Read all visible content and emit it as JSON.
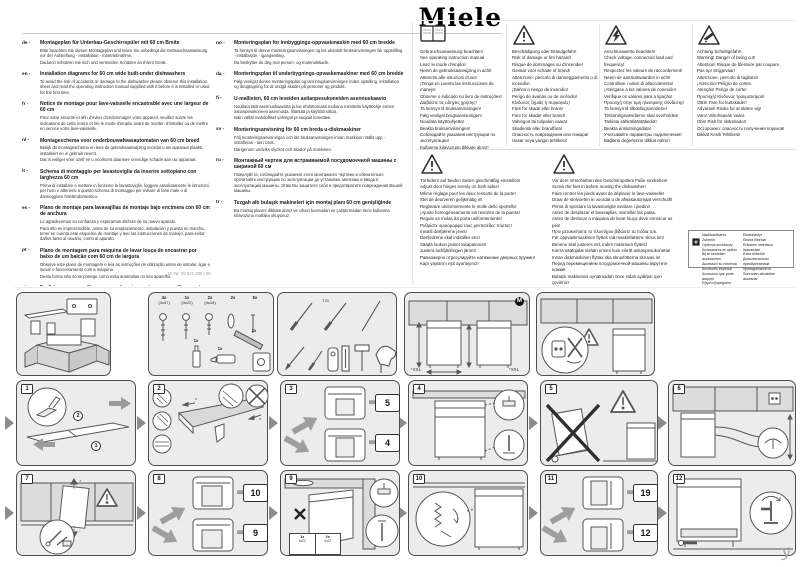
{
  "page": {
    "brand": "Miele",
    "doc_number": "M.-Nr. 09 521 280 / 00",
    "corner_mark": "y"
  },
  "intro": {
    "col1": [
      {
        "code": "de -",
        "title": "Montageplan für Unterbau-Geschirrspüler mit 60 cm Breite",
        "body": [
          "Bitte beachten Sie diesen Montageplan und lesen Sie unbedingt die Gebrauchsanweisung vor der Aufstellung - Installation - Inbetriebnahme.",
          "Dadurch schützen Sie sich und vermeiden Schäden an Ihrem Gerät."
        ]
      },
      {
        "code": "en -",
        "title": "Installation diagrams for 60 cm wide built-under dishwashers",
        "body": [
          "To avoid the risk of accidents or damage to the dishwasher please observe this installation sheet and read the operating instruction manual supplied with it before it is installed or used for the first time."
        ]
      },
      {
        "code": "fr -",
        "title": "Notice de montage pour lave-vaisselle encastrable avec une largeur de 60 cm",
        "body": [
          "Pour votre sécurité et afin d'éviter d'endommager votre appareil, veuillez suivre les indications de cette notice et lire le mode d'emploi avant de monter, d'installer ou de mettre en service votre lave-vaisselle."
        ]
      },
      {
        "code": "nl -",
        "title": "Montageschema voor onderbouwafwasautomaten van 60 cm breed",
        "body": [
          "Bekijk dit montageschema en lees de gebruiksaanwijzing voordat u uw apparaat plaatst, installeert en in gebruik neemt.",
          "Dat is veiliger voor uzelf en u voorkomt daarmee onnodige schade aan uw apparaat."
        ]
      },
      {
        "code": "it -",
        "title": "Schema di montaggio per lavastoviglie da inserire sottopiano con larghezza 60 cm",
        "body": [
          "Prima di installare e mettere in funzione la lavastoviglie, leggere assolutamente le istruzioni per l'uso e attenersi a questo schema di montaggio per evitare di farsi male o di danneggiare l'elettrodomestico."
        ]
      },
      {
        "code": "es -",
        "title": "Plano de montaje para lavavajillas de montaje bajo encimera con 60 cm de anchura",
        "body": [
          "Le agradecemos su confianza y esperamos disfrute de su nuevo aparato.",
          "Para ello es imprescindible, antes de su emplazamiento, instalación y puesta en marcha, tener en cuenta este esquema de montaje y leer las instrucciones de manejo, para evitar daños tanto al usuario, como al aparato."
        ]
      },
      {
        "code": "pt -",
        "title": "Plano de montagem para máquina de lavar louça de encastrar por baixo de um balcão com 60 cm de largura",
        "body": [
          "Observe este plano de montagem e leia as instruções de utilização antes de instalar, ligar e iniciar o funcionamento com a máquina.",
          "Desta forma não só se protege como evita anomalias no seu aparelho."
        ]
      },
      {
        "code": "el -",
        "title": "Σχεδιάγραμμα τοποθέτησης για πλυντήρια πιάτων εντοιχιζόμενα κάτω από πάγκο με 60 εκ. πλάτος",
        "body": [
          "Λάβετε υπόψη σας αυτό το σχεδιάγραμμα τοποθέτησης και διαβάστε οπωσδήποτε τις οδηγίες χρήσης, πριν από την τοποθέτηση - σύνδεση - αρχική λειτουργία.",
          "Έτσι προστατεύετε τον εαυτό σας και αποφεύγετε ζημιές στη συσκευή σας."
        ]
      }
    ],
    "col2": [
      {
        "code": "no -",
        "title": "Monteringsplan for innbyggings-oppvaskmaskin med 60 cm bredde",
        "body": [
          "Ta hensyn til denne monteringsanvisningen og les absolutt bruksanvisningen før oppstilling - installasjon - igangsetting.",
          "Da beskytter du deg mot person- og materialskade."
        ]
      },
      {
        "code": "da -",
        "title": "Monteringsplan til underbygnings-opvaskemaskiner med 60 cm bredde",
        "body": [
          "Følg venligst denne monteringsplan og læs brugsanvisningen inden opstilling, installation og ibrugtagning for at undgå skader på personer og produkt."
        ]
      },
      {
        "code": "fi -",
        "title": "U-mallisten, 60 cm leveiden astianpesukoneiden asennuskaavio",
        "body": [
          "Noudata tätä asennuskaaviota ja lue ehdottomasti mukana toimitettu käyttöohje ennen astianpesukoneen asennusta, liitäntää ja käyttöönottoa.",
          "Näin vältät mahdolliset vahingot ja suojaat konettasi."
        ]
      },
      {
        "code": "sv -",
        "title": "Monteringsanvisning för 60 cm breda u-diskmaskiner",
        "body": [
          "Följ monteringsanvisningen och läs bruksanvisningen innan maskinen ställs upp - installeras - tas i bruk.",
          "Därigenom undviks olyckor och skador på maskinen."
        ]
      },
      {
        "code": "ru -",
        "title": "Монтажный чертеж для встраиваемой посудомоечной машины с шириной 60 см",
        "body": [
          "Пожалуйста, соблюдайте указания этого монтажного чертежа и обязательно прочитайте инструкцию по эксплуатации до установки, монтажа и ввода в эксплуатацию машины. Этим Вы защитите себя и предотвратите повреждения Вашей машины."
        ]
      },
      {
        "code": "tr -",
        "title": "Tezgah altı bulaşık makineleri için montaj planı 60 cm genişliğinde",
        "body": [
          "Bu montaj planını dikkate alınız ve cihazı kurmadan ve çalıştırmadan önce kullanma kılavuzunu mutlaka okuyunuz."
        ]
      }
    ]
  },
  "warnings": {
    "manual": {
      "lines": [
        "Gebrauchsanweisung beachten!",
        "See operating instruction manual",
        "Lisez le mode d'emploi!",
        "Neem de gebruiksaanwijzing in acht!",
        "Attenersi alle istruzioni d'uso!",
        "¡Tenga en cuenta las instrucciones de manejo!",
        "Observe o indicado no livro de instruções!",
        "Διαβάστε τις οδηγίες χρήσης!",
        "Ta hensyn til bruksanvisningen!",
        "Følg venligst brugsanvisningen!",
        "Noudata käyttöohjetta!",
        "Beakta bruksanvisningen!",
        "Соблюдайте указания инструкции по эксплуатации!",
        "Kullanma kılavuzunu dikkate alınız!"
      ]
    },
    "fire": {
      "lines": [
        "Beschädigung oder Brandgefahr!",
        "Risk of damage or fire hazard!",
        "Risque de dommages ou d'incendie!",
        "Gevaar voor schade of brand!",
        "Attenzione: pericolo di danneggiamento o di incendio!",
        "¡Daños o riesgo de incendio!",
        "Perigo de avarias ou de incêndio!",
        "Κίνδυνος ζημιάς ή πυρκαγιάς!",
        "Fare for skade eller brann!",
        "Fare for skader eller brand!",
        "Vahingon tai tulipalon vaara!",
        "Skaderisk eller brandfara!",
        "Опасность повреждения или пожара!",
        "Hasar veya yangın tehlikesi!"
      ]
    },
    "electrical": {
      "lines": [
        "Anschlusswerte beachten!",
        "Check voltage, connected load and frequency!",
        "Respectez les valeurs de raccordement!",
        "Neem de aansluitwaarden in acht!",
        "Controllare i valori di allacciamento!",
        "¡Aténgase a los valores de conexión!",
        "Verifique os valores para a ligação!",
        "Προσοχή στην τιμή ηλεκτρικής σύνδεσης!",
        "Ta hensyn til tilkoblingsverdiene!",
        "Tilslutningsværdierne skal overholdes!",
        "Tarkista sähköliitäntätiedot!",
        "Beakta anslutningsdata!",
        "Учитывайте параметры подключения!",
        "Bağlantı değerlerine dikkat ediniz!"
      ]
    },
    "cut": {
      "lines": [
        "Achtung Schnittgefahr!",
        "Warning! Danger of being cut!",
        "Attention! Risque de blessure par coupure.",
        "Pas op! Snijgevaar!",
        "Attenzione, pericolo di tagliarsi!",
        "¡Atención! Peligro de cortes.",
        "Atenção! Perigo de corte!",
        "Προσοχή! Κίνδυνος τραυματισμού!",
        "OBS! Fare for kuttskader!",
        "Advarsel! Risiko for at skære sig!",
        "Varo! Viiltohaavan vaara",
        "Obs! Risk för skärskador!",
        "Осторожно: опасность получения порезов!",
        "Dikkat Kesik Tehlikesi!"
      ]
    },
    "springs": {
      "lines": [
        "Türfedern auf beiden Seiten gleichmäßig einstellen!",
        "Adjust door hinges evenly on both sides!",
        "Même réglage pour les deux ressorts de la porte!",
        "Stel de deurveren gelijkmatig in!",
        "Registrare uniformemente le molle dello sportello!",
        "¡Ajuste homogéneamente los resortes de la puerta!",
        "Regule as molas da porta uniformemente!",
        "Ρυθμίστε ομοιόμορφα τους μεντεσέδες πόρτας!",
        "Innstill dørfjærene jevnt!",
        "Dørfjedrene skal indstilles ens!",
        "Säädä luukun jouset tasapainoon!",
        "Justera luckfjädringen jämnt!",
        "Равномерно отрегулируйте натяжение дверных пружин!",
        "Kapı yaylarını eşit ayarlayınız!"
      ]
    },
    "feet": {
      "lines": [
        "Vor dem Verschieben des Geschirrspülers Füße eindrehen!",
        "Screw the feet in before moving the dishwasher!",
        "Faire rentrer les pieds avant de déplacer le lave-vaisselle!",
        "Draai de stelvoeten in voordat u de afwasautomaat verschuift!",
        "Prima di spostare la lavastoviglie avvitare i piedini!",
        "Antes de desplazar el lavavajillas, atornillar las patas.",
        "Antes de deslocar a máquina de lavar louça deve enroscar os pés!",
        "Πριν μετακινήσετε το πλυντήριο βιδώστε τα πόδια του.",
        "Før oppvaskmaskinen flyttes må maskinføttene skrus inn!",
        "Benene skal justeres ind, inden maskinen flyttes!",
        "Kierrä säätöjalat sisään ennen kuin siirrät astianpesukonetta!",
        "Innan diskmaskinen flyttas ska skruvfötterna skruvas in!",
        "Перед перемещением посудомоечной машины вкрутите ножки!",
        "Bulaşık makinesini oynatmadan önce vidalı ayakları içeri çeviriniz!"
      ]
    }
  },
  "accessory": {
    "left": [
      "Nachkaufbares Zubehör",
      "Optional accessory",
      "Accessoires en option",
      "Bij te bestellen accessoires",
      "Accessori su richiesta",
      "Accesorio especial",
      "Acessório que pode adquirir",
      "Εξτρά εξαρτήματα"
    ],
    "right": [
      "Ekstrautstyr",
      "Ekstra tilbehør",
      "Erikseen ostettava lisävaruste",
      "Extra tillbehör",
      "Дополнительно приобретаемые принадлежности",
      "Sonradan alınabilen aksesuar"
    ]
  },
  "diagrams": {
    "screw_kit": [
      {
        "qty": "4x",
        "size": "(4x37)"
      },
      {
        "qty": "1x",
        "size": "(4x22)"
      },
      {
        "qty": "2x",
        "size": "(4x16)"
      },
      {
        "qty": "2x",
        "size": ""
      },
      {
        "qty": "5x",
        "size": ""
      }
    ],
    "extra_parts": {
      "p1": "1x",
      "p2": "1x",
      "p3": "2x"
    },
    "tools_label": "T20",
    "niche": {
      "xxl_left": "*XXL",
      "xxl_right": "*XXL",
      "brand_mark": "M"
    },
    "steps": [
      {
        "n": "1",
        "subs": [
          "1",
          "2"
        ]
      },
      {
        "n": "2",
        "subs": [
          "x",
          "x"
        ]
      },
      {
        "n": "3",
        "refs": [
          "5",
          "4"
        ]
      },
      {
        "n": "4"
      },
      {
        "n": "5"
      },
      {
        "n": "6"
      },
      {
        "n": "7",
        "subs": [
          "+",
          "-"
        ]
      },
      {
        "n": "8",
        "refs": [
          "10",
          "9"
        ]
      },
      {
        "n": "9",
        "screws": [
          {
            "qty": "1x",
            "size": "4x22"
          },
          {
            "qty": "2x",
            "size": "4x27"
          }
        ]
      },
      {
        "n": "10"
      },
      {
        "n": "11",
        "refs": [
          "19",
          "12"
        ]
      },
      {
        "n": "12"
      }
    ]
  }
}
